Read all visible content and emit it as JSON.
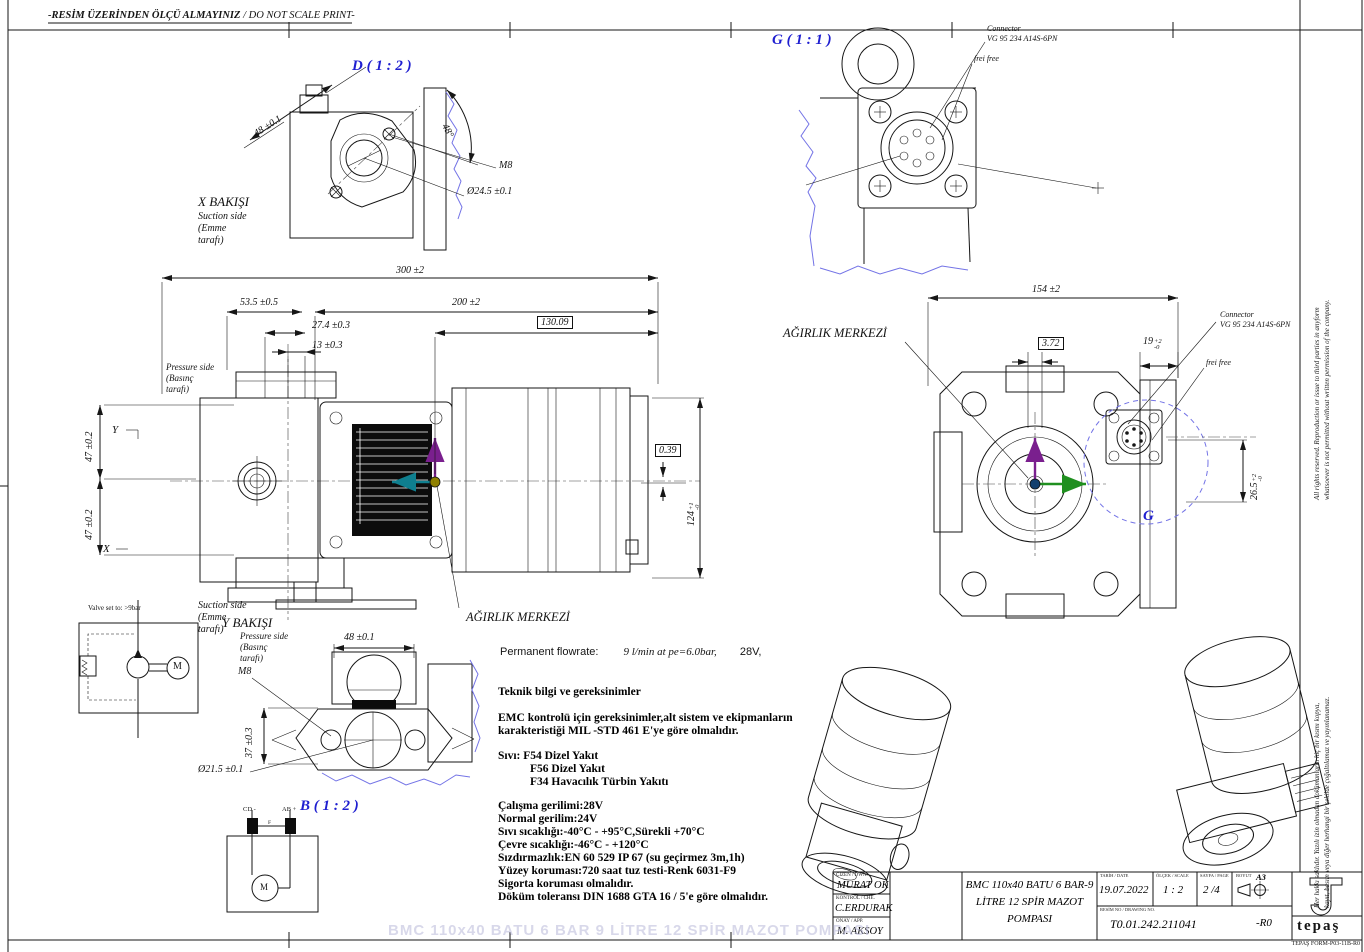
{
  "sheet": {
    "no_scale_tr": "-RESİM ÜZERİNDEN ÖLÇÜ ALMAYINIZ",
    "no_scale_en": " / DO NOT SCALE PRINT-",
    "watermark": "BMC 110x40 BATU 6 BAR 9 LİTRE 12 SPİR MAZOT POMPASI",
    "form_no": "TEPAŞ FORM-P03-11B-R0",
    "margin_en_1": "All rights reserved. Reproduction or issue to third parties in anyform",
    "margin_en_2": "whatsoever is not permitted without written permission of the company.",
    "margin_tr_1": "Her hakkı saklıdır. Yazılı izin olmadan dokümanların hiç bir kısmı kopya,",
    "margin_tr_2": "kayıt, basım veya diğer herhangi bir şekilde çoğaltılamaz ve yayınlanamaz."
  },
  "detail_d": {
    "title": "D ( 1 : 2 )",
    "dim_width": "48 ±0.1",
    "angle": "48°",
    "thread": "M8",
    "bore": "Ø24.5 ±0.1"
  },
  "x_view": {
    "title": "X BAKIŞI",
    "line1": "Suction side",
    "line2": "(Emme",
    "line3": "tarafı)"
  },
  "front_view": {
    "dim_total": "300 ±2",
    "dim_53": "53.5 ±0.5",
    "dim_200": "200 ±2",
    "dim_27": "27.4 ±0.3",
    "dim_13": "13 ±0.3",
    "cg_x": "130.09",
    "cg_y": "0.39",
    "height": {
      "v": "124",
      "u": "+1",
      "l": "-0"
    },
    "dim_47a": "47 ±0.2",
    "dim_47b": "47 ±0.2",
    "axis_y": "Y",
    "axis_x": "X",
    "pressure1": "Pressure side",
    "pressure2": "(Basınç",
    "pressure3": "tarafı)",
    "suction1": "Suction side",
    "suction2": "(Emme",
    "suction3": "tarafı)",
    "cg_label": "AĞIRLIK MERKEZİ"
  },
  "right_view": {
    "dim_total": "154 ±2",
    "cg_label": "AĞIRLIK MERKEZİ",
    "cg_y": "3.72",
    "conn_w": {
      "v": "19",
      "u": "+2",
      "l": "-0"
    },
    "conn_h": {
      "v": "26.5",
      "u": "+2",
      "l": "-0"
    },
    "detail_ref": "G",
    "connector1": "Connector",
    "connector2": "VG 95 234 A14S-6PN",
    "frei": "frei free"
  },
  "detail_g": {
    "title": "G ( 1 : 1 )",
    "connector1": "Connector",
    "connector2": "VG 95 234 A14S-6PN",
    "frei": "frei free"
  },
  "y_view": {
    "title": "Y BAKIŞI",
    "line1": "Pressure side",
    "line2": "(Basınç",
    "line3": "tarafı)",
    "thread": "M8",
    "dim_width": "48 ±0.1",
    "dim_37": "37 ±0.3",
    "bore": "Ø21.5 ±0.1",
    "detail_b": "B ( 1 : 2 )"
  },
  "hydraulic": {
    "note": "Valve set to: >9bar",
    "motor": "M"
  },
  "electric": {
    "term_neg": "CD -",
    "term_pos": "AB +",
    "fuse": "F",
    "motor": "M"
  },
  "specs": {
    "flow_label": "Permanent flowrate:",
    "flow_value": "9 l/min  at  pe=6.0bar,",
    "flow_v2": "28V,",
    "heading": "Teknik bilgi ve gereksinimler",
    "emc1": "EMC kontrolü için gereksinimler,alt sistem ve ekipmanların",
    "emc2": "karakteristiği MIL -STD 461 E'ye göre olmalıdır.",
    "fluid0": "Sıvı: F54 Dizel Yakıt",
    "fluid1": "F56 Dizel Yakıt",
    "fluid2": "F34 Havacılık Türbin Yakıtı",
    "lines": [
      "Çalışma gerilimi:28V",
      "Normal gerilim:24V",
      "Sıvı sıcaklığı:-40°C  -  +95°C,Sürekli +70°C",
      "Çevre sıcaklığı:-46°C  -  +120°C",
      "Sızdırmazlık:EN 60 529 IP 67 (su geçirmez 3m,1h)",
      "Yüzey koruması:720 saat tuz testi-Renk 6031-F9",
      "Sigorta koruması olmalıdır.",
      "Döküm toleransı DIN 1688 GTA 16 / 5'e göre olmalıdır."
    ]
  },
  "title_block": {
    "drawn_label": "ÇİZEN / DWN.",
    "drawn": "MURAT OK",
    "checked_label": "KONTROL / CHE.",
    "checked": "C.ERDURAK",
    "approved_label": "ONAY / APP.",
    "approved": "M. AKSOY",
    "title1": "BMC 110x40 BATU 6 BAR-9",
    "title2": "LİTRE 12 SPİR MAZOT",
    "title3": "POMPASI",
    "date_label": "TARİH / DATE",
    "date": "19.07.2022",
    "scale_label": "ÖLÇEK / SCALE",
    "scale": "1 : 2",
    "page_label": "SAYFA / PAGE",
    "page": "2 /4",
    "size_label": "BOYUT",
    "size": "A3",
    "dwg_label": "RESİM NO / DRAWING NO.",
    "dwg_no": "T0.01.242.211041",
    "rev": "-R0",
    "logo": "tepaş"
  },
  "colors": {
    "detail_blue": "#1f1fd0",
    "break_blue": "#7373e6",
    "cg_purple": "#7a1f8e",
    "cg_teal": "#0f7f8f",
    "cg_olive": "#8f8000",
    "cg_green": "#1f8f1f",
    "cg_navy": "#14406e"
  }
}
